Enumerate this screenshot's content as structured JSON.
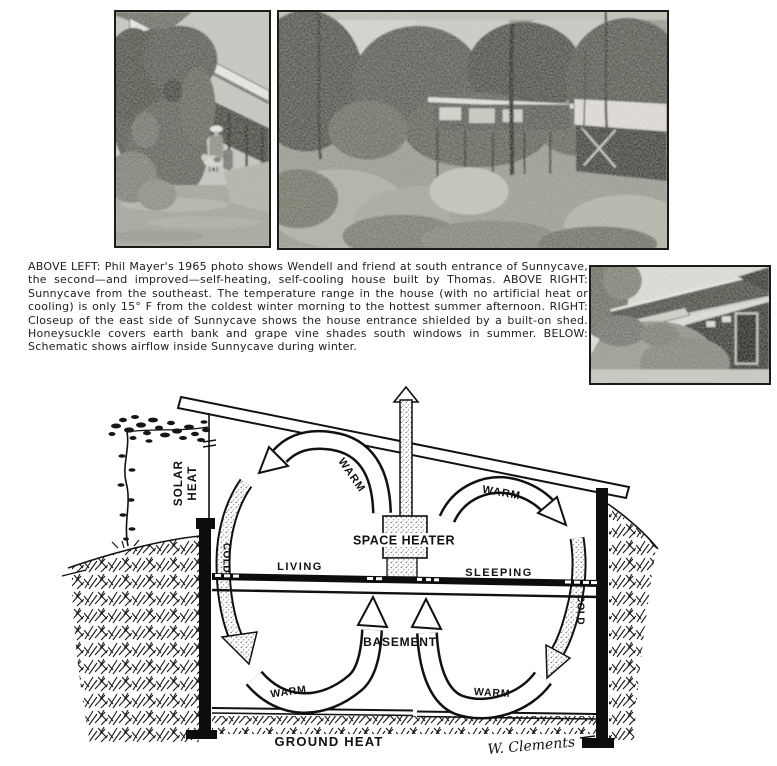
{
  "colors": {
    "ink": "#111111",
    "paper": "#ffffff"
  },
  "caption": {
    "lines": [
      "ABOVE LEFT: Phil Mayer's 1965 photo shows Wendell and friend at south entrance of Sunnycave,",
      "the second—and improved—self-heating, self-cooling house built by Thomas. ABOVE RIGHT:",
      "Sunnycave from the southeast. The temperature range in the house (with no artificial heat or",
      "cooling) is only 15° F from the coldest winter morning to the hottest summer afternoon. RIGHT:",
      "Closeup of the east side of Sunnycave shows the house entrance shielded by a built-on shed.",
      "Honeysuckle covers earth bank and grape vine shades south windows in summer. BELOW:",
      "Schematic shows airflow inside Sunnycave during winter."
    ]
  },
  "diagram": {
    "labels": {
      "solar": "SOLAR",
      "heat": "HEAT",
      "warm_top_left": "WARM",
      "warm_top_right": "WARM",
      "cold_left": "COLD",
      "cold_right": "COLD",
      "space_heater": "SPACE HEATER",
      "living": "LIVING",
      "sleeping": "SLEEPING",
      "basement": "BASEMENT",
      "warm_basement_left": "WARM",
      "warm_basement_right": "WARM",
      "ground_heat": "GROUND HEAT",
      "signature": "W. Clements"
    }
  }
}
